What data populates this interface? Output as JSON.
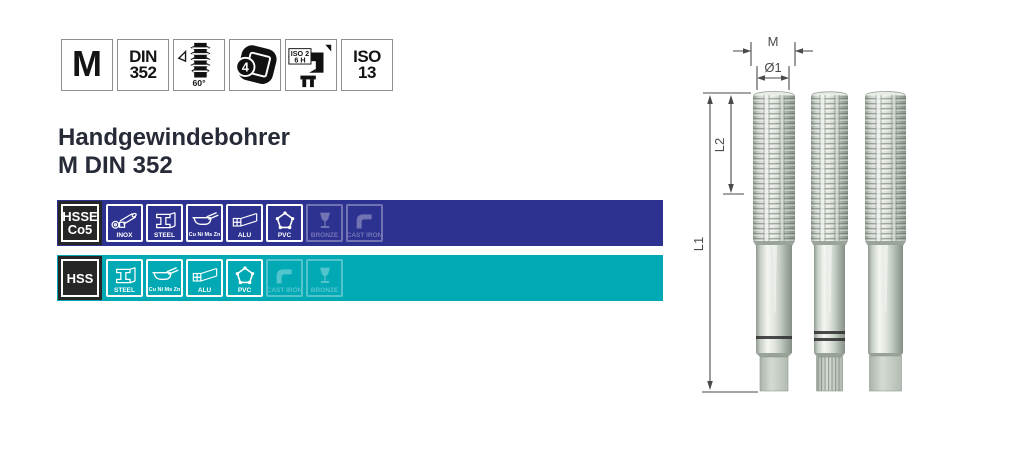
{
  "title": {
    "line1": "Handgewindebohrer",
    "line2": "M DIN 352"
  },
  "badges": {
    "thread_type": "M",
    "din_line1": "DIN",
    "din_line2": "352",
    "flank_angle": "60°",
    "square_drive": "4",
    "iso2_line1": "ISO 2",
    "iso2_line2": "6 H",
    "iso13_line1": "ISO",
    "iso13_line2": "13"
  },
  "bars": [
    {
      "grade_line1": "HSSE",
      "grade_line2": "Co5",
      "color": "#2d3190",
      "materials": [
        {
          "label": "INOX",
          "active": true
        },
        {
          "label": "STEEL",
          "active": true
        },
        {
          "label": "Cu Ni Ms Zn",
          "active": true
        },
        {
          "label": "ALU",
          "active": true
        },
        {
          "label": "PVC",
          "active": true
        },
        {
          "label": "BRONZE",
          "active": false
        },
        {
          "label": "CAST IRON",
          "active": false
        }
      ]
    },
    {
      "grade_line1": "HSS",
      "grade_line2": "",
      "color": "#00a9b4",
      "materials": [
        {
          "label": "STEEL",
          "active": true
        },
        {
          "label": "Cu Ni Ms Zn",
          "active": true
        },
        {
          "label": "ALU",
          "active": true
        },
        {
          "label": "PVC",
          "active": true
        },
        {
          "label": "CAST IRON",
          "active": false
        },
        {
          "label": "BRONZE",
          "active": false
        }
      ]
    }
  ],
  "diagram": {
    "dim_m": "M",
    "dim_d1": "Ø1",
    "dim_l1": "L1",
    "dim_l2": "L2"
  }
}
